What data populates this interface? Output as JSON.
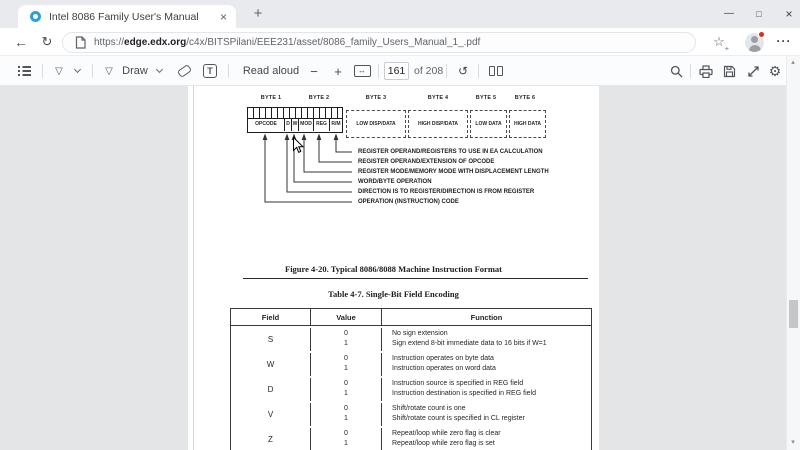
{
  "browser": {
    "tab_title": "Intel 8086 Family User's Manual",
    "url": {
      "scheme": "https://",
      "host": "edge.edx.org",
      "path": "/c4x/BITSPilani/EEE231/asset/8086_family_Users_Manual_1_.pdf"
    }
  },
  "icons": {
    "close": "×",
    "new_tab": "+",
    "back": "←",
    "refresh": "↻",
    "more": "···",
    "star": "☆",
    "star_plus": "+",
    "minimize": "—",
    "maximize": "□",
    "minus": "−",
    "plus": "+",
    "fit_width": "↔",
    "rotate": "↺",
    "gear": "⚙",
    "text_tool": "T",
    "pen_nib": "▽",
    "scroll_up": "▴",
    "scroll_down": "▾"
  },
  "pdf_toolbar": {
    "draw_label": "Draw",
    "read_aloud_label": "Read aloud",
    "page_number": "161",
    "page_count_label": "of 208"
  },
  "document": {
    "figure": {
      "byte_labels": [
        "BYTE 1",
        "BYTE 2",
        "BYTE 3",
        "BYTE 4",
        "BYTE 5",
        "BYTE 6"
      ],
      "field_cells": [
        "OPCODE",
        "D",
        "W",
        "MOD",
        "REG",
        "R/M"
      ],
      "optional_bytes": [
        "LOW DISP/DATA",
        "HIGH DISP/DATA",
        "LOW DATA",
        "HIGH DATA"
      ],
      "callouts": [
        "REGISTER OPERAND/REGISTERS TO USE IN EA CALCULATION",
        "REGISTER OPERAND/EXTENSION OF OPCODE",
        "REGISTER MODE/MEMORY MODE WITH DISPLACEMENT LENGTH",
        "WORD/BYTE OPERATION",
        "DIRECTION IS TO REGISTER/DIRECTION IS FROM REGISTER",
        "OPERATION (INSTRUCTION) CODE"
      ],
      "caption": "Figure 4-20. Typical 8086/8088 Machine Instruction Format"
    },
    "table": {
      "caption": "Table 4-7. Single-Bit Field Encoding",
      "headers": [
        "Field",
        "Value",
        "Function"
      ],
      "rows": [
        {
          "field": "S",
          "v0": "0",
          "v1": "1",
          "f0": "No sign extension",
          "f1": "Sign extend 8-bit immediate data to 16 bits if W=1"
        },
        {
          "field": "W",
          "v0": "0",
          "v1": "1",
          "f0": "Instruction operates on byte data",
          "f1": "Instruction operates on word data"
        },
        {
          "field": "D",
          "v0": "0",
          "v1": "1",
          "f0": "Instruction source is specified in REG field",
          "f1": "Instruction destination is specified in REG field"
        },
        {
          "field": "V",
          "v0": "0",
          "v1": "1",
          "f0": "Shift/rotate count is one",
          "f1": "Shift/rotate count is specified in CL register"
        },
        {
          "field": "Z",
          "v0": "0",
          "v1": "1",
          "f0": "Repeat/loop while zero flag is clear",
          "f1": "Repeat/loop while zero flag is set"
        }
      ]
    }
  },
  "colors": {
    "favicon_ring": "#2b9fd8",
    "notification_badge": "#d93025",
    "content_background": "#e4e5e6"
  }
}
